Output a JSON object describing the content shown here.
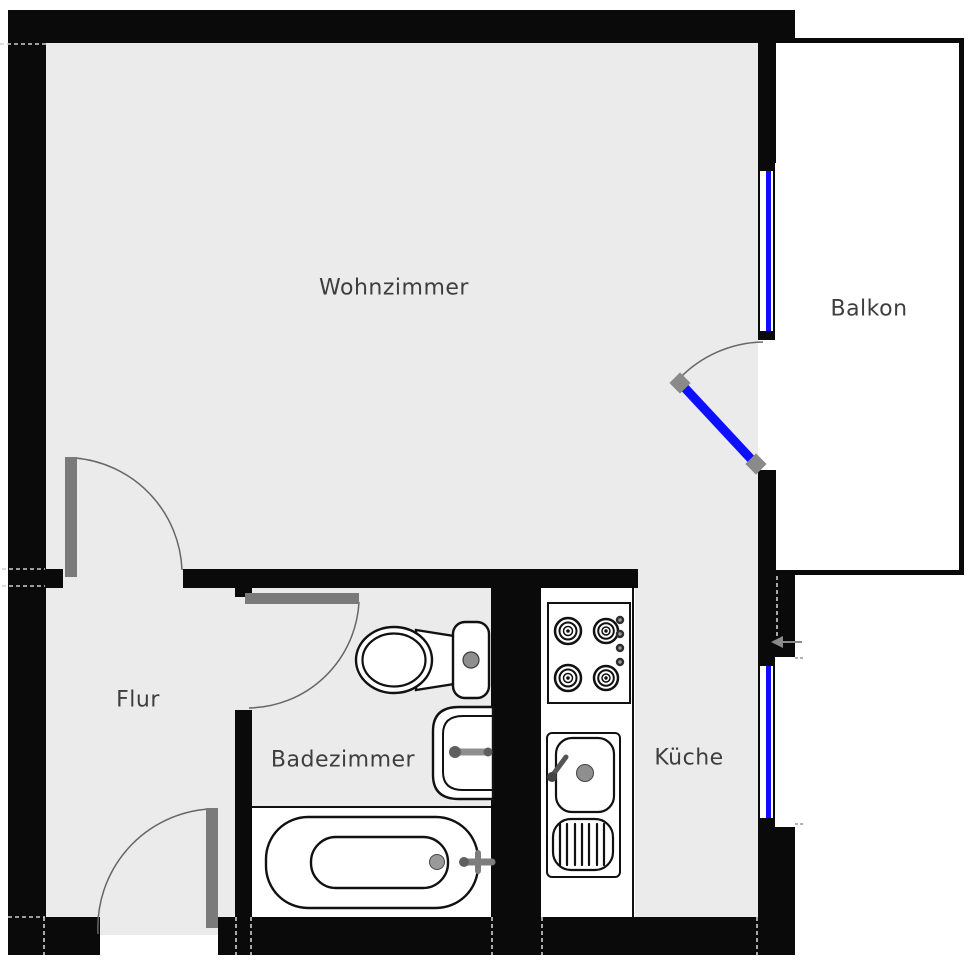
{
  "title": "Apartment floor plan",
  "rooms": [
    {
      "id": "wohnzimmer",
      "label": "Wohnzimmer"
    },
    {
      "id": "balkon",
      "label": "Balkon"
    },
    {
      "id": "flur",
      "label": "Flur"
    },
    {
      "id": "badezimmer",
      "label": "Badezimmer"
    },
    {
      "id": "kueche",
      "label": "Küche"
    }
  ],
  "fixtures": [
    {
      "id": "stove",
      "room": "kueche",
      "type": "4-burner cooktop with knobs"
    },
    {
      "id": "kitchen-sink",
      "room": "kueche",
      "type": "sink with drainboard and faucet"
    },
    {
      "id": "toilet",
      "room": "badezimmer",
      "type": "toilet with tank"
    },
    {
      "id": "bathroom-sink",
      "room": "badezimmer",
      "type": "wall-mounted basin with faucet"
    },
    {
      "id": "bathtub",
      "room": "badezimmer",
      "type": "bathtub with faucet and drain"
    }
  ],
  "doors": [
    {
      "id": "entrance-door",
      "between": "outside / Flur",
      "state": "open 90°"
    },
    {
      "id": "living-room-door",
      "between": "Flur / Wohnzimmer",
      "state": "open 90°"
    },
    {
      "id": "bathroom-door",
      "between": "Flur / Badezimmer",
      "state": "open 90°"
    },
    {
      "id": "balcony-door",
      "between": "Wohnzimmer / Balkon",
      "state": "open 45°",
      "glazed": true
    }
  ],
  "windows": [
    {
      "id": "living-room-window",
      "wall": "right",
      "room": "wohnzimmer"
    },
    {
      "id": "kitchen-window",
      "wall": "right",
      "room": "kueche"
    }
  ],
  "annotations": [
    {
      "id": "entry-arrow",
      "type": "arrow-left",
      "meaning": "direction marker at kitchen window wall"
    }
  ],
  "colors": {
    "wall": "#0a0a0a",
    "floor": "#ebebeb",
    "outside": "#ffffff",
    "window-blue": "#0f0fff",
    "door-gray": "#7a7a7a",
    "label": "#3e3e3e",
    "outline": "#111111",
    "fixture-gray": "#8f8f8f"
  }
}
